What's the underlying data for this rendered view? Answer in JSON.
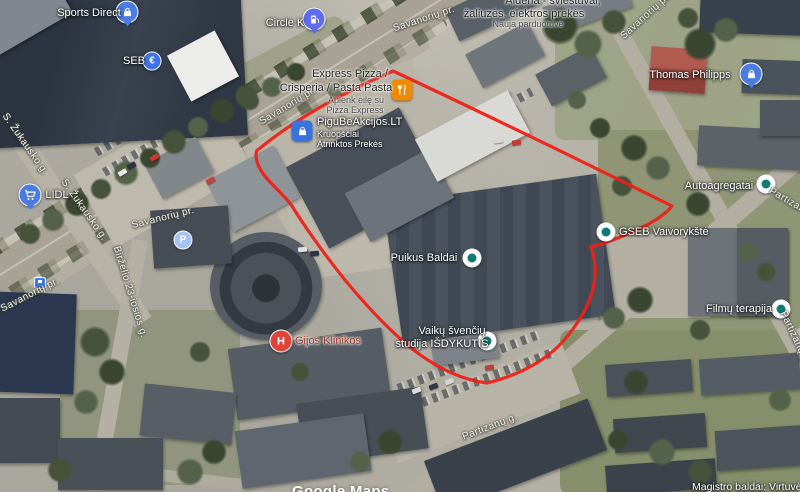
{
  "map": {
    "watermark": "Google Maps",
    "route_color": "#ee2117",
    "poi_dot_color": "#0e7b74",
    "pin_blue": "#4b7de0"
  },
  "streets": {
    "savanoriu": "Savanorių pr.",
    "zukausko": "S. Žukausko g.",
    "birzelio": "Birželio 23-iosios g.",
    "partizanu": "Partizanų g."
  },
  "pois": {
    "sports_direct": {
      "name": "Sports Direct",
      "icon": "shopping-bag"
    },
    "seb": {
      "name": "SEB",
      "glyph": "€"
    },
    "circle_k": {
      "name": "Circle K",
      "icon": "fuel-pump"
    },
    "lidl": {
      "name": "LIDL",
      "icon": "shopping-cart"
    },
    "express_pizza": {
      "title1": "Express Pizza /",
      "title2": "Crisperia / Pasta Pasta",
      "sub1": "Aplenk eilę su",
      "sub2": "Pizza Express",
      "icon": "restaurant"
    },
    "pigu": {
      "name": "PiguBeAkcijos.LT",
      "sub1": "Kruopščiai",
      "sub2": "Atrinktos Prekės",
      "icon": "shopping-bag"
    },
    "thomas_philipps": {
      "name": "Thomas Philipps",
      "icon": "shopping-bag"
    },
    "aldena": {
      "line1": "Aldena - šviestuvai,",
      "line2": "žaliuzės, elektros prekės",
      "line3": "Nauja parduotuvė"
    },
    "gseb": {
      "name": "GSEB Vaivorykštė"
    },
    "puikus_baldai": {
      "name": "Puikus Baldai"
    },
    "autoagregatai": {
      "name": "Autoagregatai"
    },
    "filmu_terapija": {
      "name": "Filmų terapija"
    },
    "vaiku_studija": {
      "line1": "Vaikų švenčių",
      "line2": "studija IŠDYKUTIS"
    },
    "gijos_klinikos": {
      "name": "Gijos Klinikos",
      "glyph": "H"
    },
    "magistro": {
      "name": "Magistro baldai: Virtuvės"
    },
    "parking": {
      "glyph": "P"
    }
  }
}
